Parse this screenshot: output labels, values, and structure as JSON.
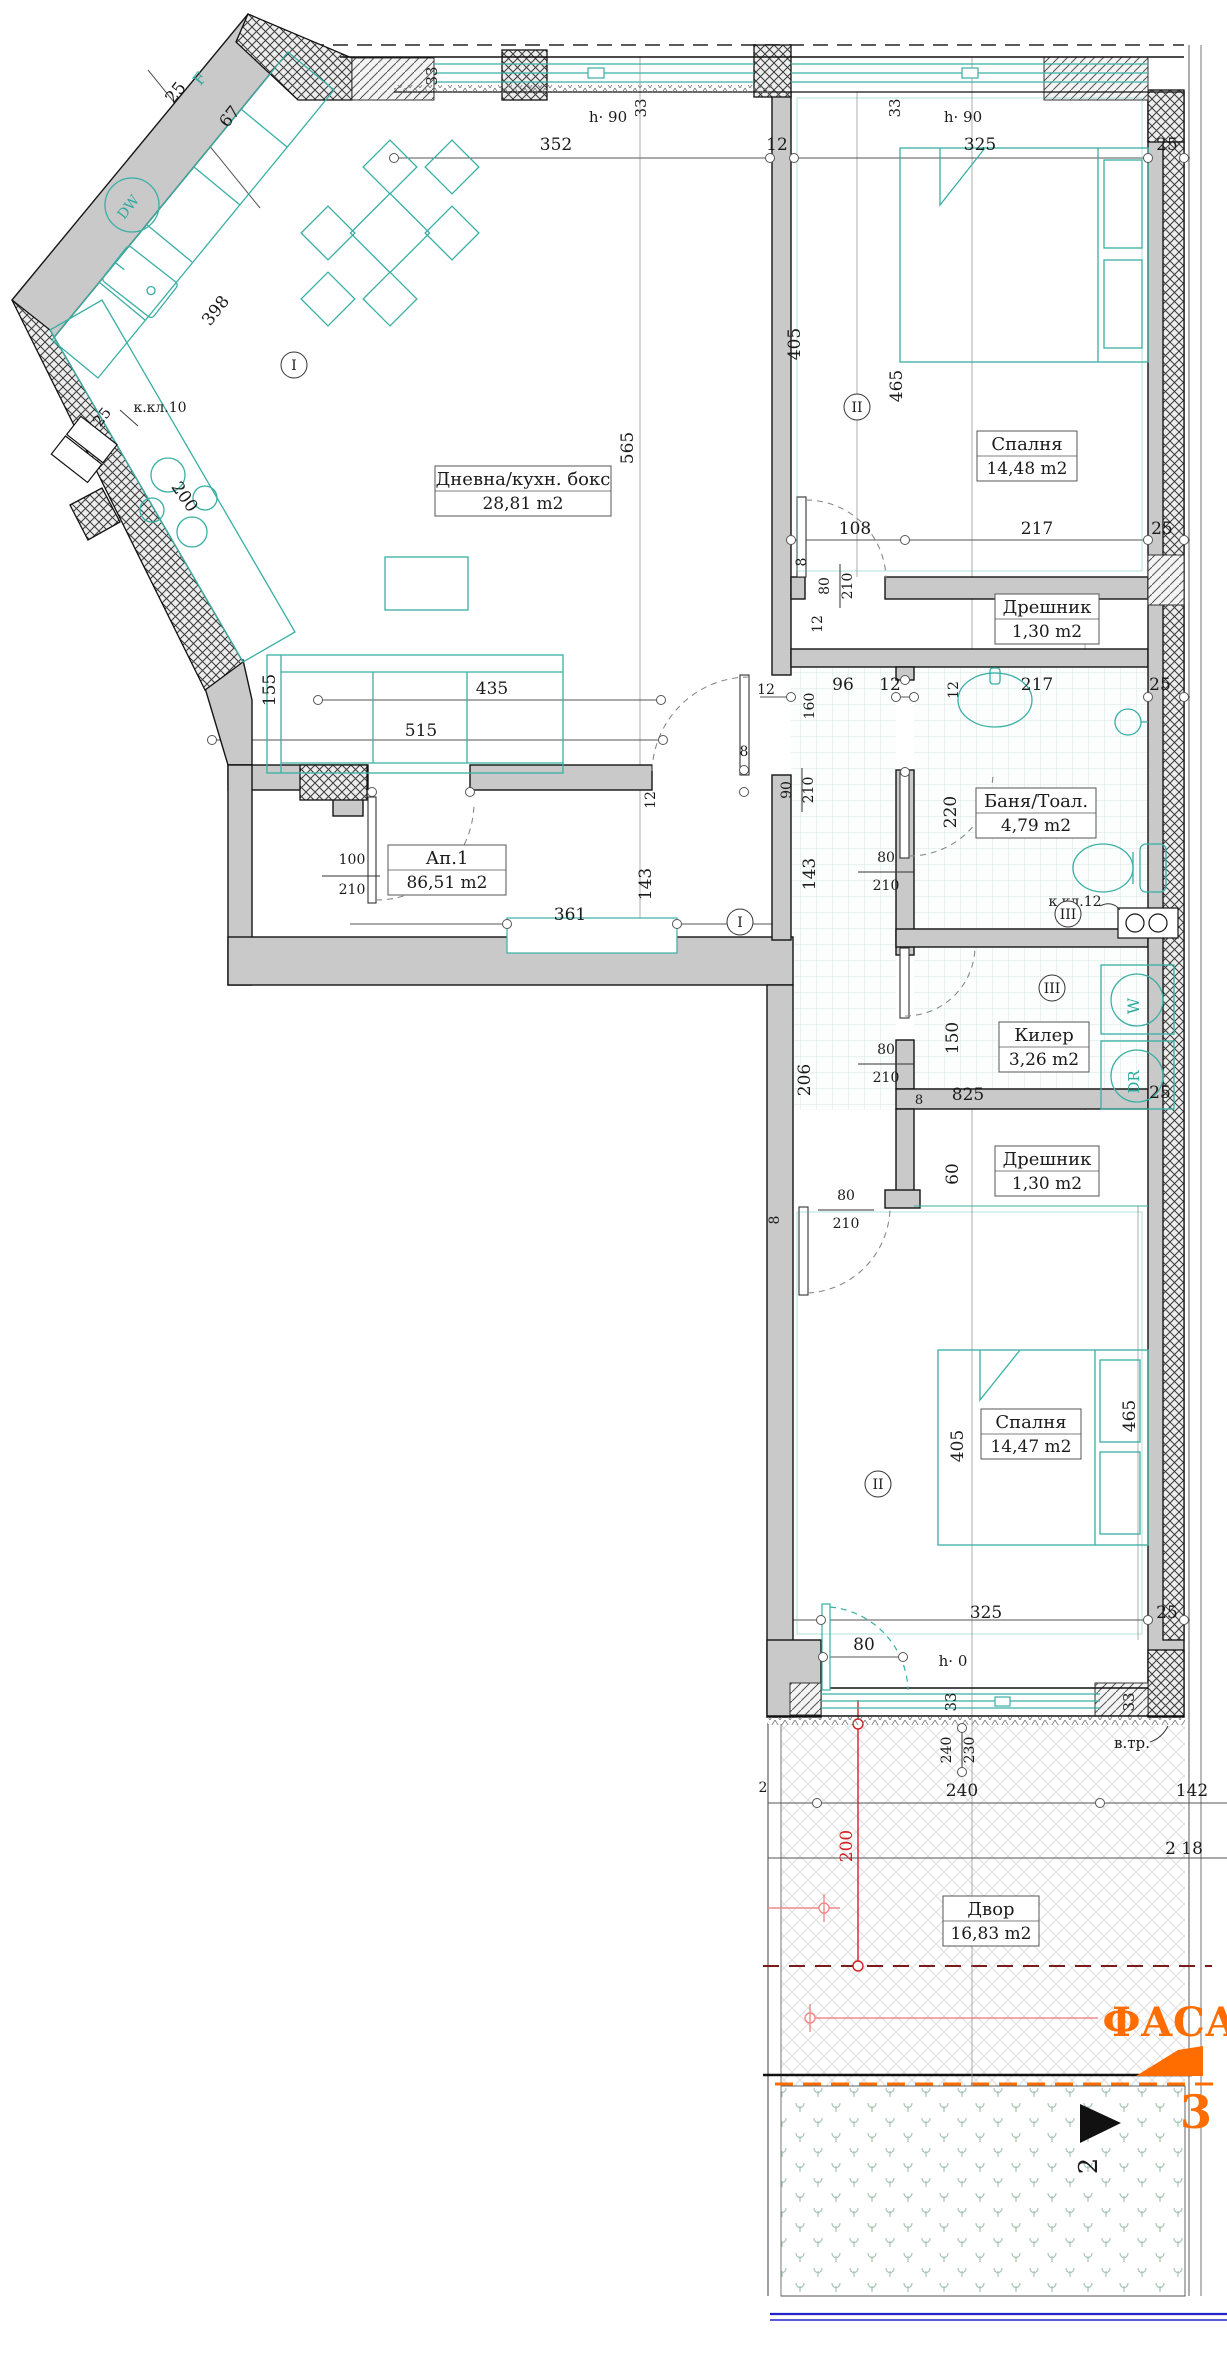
{
  "plan": {
    "title": "Apartment floor plan Ап.1",
    "colors": {
      "wall_gray": "#c9c9c9",
      "furniture_teal": "#38afa4",
      "dim_line": "#555555",
      "red_dim": "#d42020",
      "pink_dim": "#f08a8a",
      "dark_red_dashed": "#7a1b1b",
      "orange_accent": "#ff6d00",
      "blue_line": "#2323cc",
      "grass_green": "#a9c7b6"
    },
    "rooms": [
      {
        "name": "Дневна/кухн. бокс",
        "area": "28,81 m2",
        "cx": 523,
        "top": 466,
        "w": 176
      },
      {
        "name": "Спалня",
        "area": "14,48 m2",
        "cx": 1027,
        "top": 431,
        "w": 100
      },
      {
        "name": "Дрешник",
        "area": "1,30 m2",
        "cx": 1047,
        "top": 594,
        "w": 104
      },
      {
        "name": "Баня/Тоал.",
        "area": "4,79 m2",
        "cx": 1036,
        "top": 788,
        "w": 120
      },
      {
        "name": "Килер",
        "area": "3,26 m2",
        "cx": 1044,
        "top": 1022,
        "w": 90
      },
      {
        "name": "Дрешник",
        "area": "1,30 m2",
        "cx": 1047,
        "top": 1146,
        "w": 104
      },
      {
        "name": "Спалня",
        "area": "14,47 m2",
        "cx": 1031,
        "top": 1409,
        "w": 100
      },
      {
        "name": "Ап.1",
        "area": "86,51 m2",
        "cx": 447,
        "top": 845,
        "w": 118
      },
      {
        "name": "Двор",
        "area": "16,83 m2",
        "cx": 991,
        "top": 1896,
        "w": 96
      }
    ],
    "axis_markers": [
      {
        "t": "I",
        "x": 294,
        "y": 365
      },
      {
        "t": "I",
        "x": 740,
        "y": 922
      },
      {
        "t": "II",
        "x": 857,
        "y": 407
      },
      {
        "t": "II",
        "x": 878,
        "y": 1484
      },
      {
        "t": "III",
        "x": 1068,
        "y": 914
      },
      {
        "t": "III",
        "x": 1052,
        "y": 988
      }
    ],
    "labels": [
      {
        "t": "352",
        "x": 556,
        "y": 150
      },
      {
        "t": "12",
        "x": 777,
        "y": 150
      },
      {
        "t": "325",
        "x": 980,
        "y": 150
      },
      {
        "t": "25",
        "x": 1167,
        "y": 150
      },
      {
        "t": "h· 90",
        "x": 608,
        "y": 122,
        "s": 15
      },
      {
        "t": "h· 90",
        "x": 963,
        "y": 122,
        "s": 15
      },
      {
        "t": "33",
        "x": 437,
        "y": 76,
        "r": -90,
        "s": 15
      },
      {
        "t": "33",
        "x": 646,
        "y": 108,
        "r": -90,
        "s": 15
      },
      {
        "t": "33",
        "x": 900,
        "y": 108,
        "r": -90,
        "s": 15
      },
      {
        "t": "25",
        "x": 180,
        "y": 96,
        "r": -52
      },
      {
        "t": "67",
        "x": 234,
        "y": 120,
        "r": -52
      },
      {
        "t": "398",
        "x": 220,
        "y": 314,
        "r": -52
      },
      {
        "t": "200",
        "x": 180,
        "y": 500,
        "r": 55
      },
      {
        "t": "25",
        "x": 106,
        "y": 420,
        "r": -52,
        "s": 15
      },
      {
        "t": "565",
        "x": 633,
        "y": 448,
        "r": -90
      },
      {
        "t": "155",
        "x": 275,
        "y": 690,
        "r": -90
      },
      {
        "t": "435",
        "x": 492,
        "y": 694
      },
      {
        "t": "515",
        "x": 421,
        "y": 736
      },
      {
        "t": "405",
        "x": 800,
        "y": 344,
        "r": -90
      },
      {
        "t": "465",
        "x": 902,
        "y": 386,
        "r": -90
      },
      {
        "t": "108",
        "x": 855,
        "y": 534
      },
      {
        "t": "217",
        "x": 1037,
        "y": 534
      },
      {
        "t": "25",
        "x": 1162,
        "y": 534
      },
      {
        "t": "8",
        "x": 806,
        "y": 562,
        "r": -90,
        "s": 14
      },
      {
        "t": "80",
        "x": 829,
        "y": 586,
        "r": -90,
        "s": 14
      },
      {
        "t": "210",
        "x": 852,
        "y": 586,
        "r": -90,
        "s": 14
      },
      {
        "t": "12",
        "x": 822,
        "y": 624,
        "r": -90,
        "s": 14
      },
      {
        "t": "12",
        "x": 766,
        "y": 694,
        "s": 14
      },
      {
        "t": "160",
        "x": 814,
        "y": 706,
        "r": -90,
        "s": 14
      },
      {
        "t": "96",
        "x": 843,
        "y": 690
      },
      {
        "t": "12",
        "x": 890,
        "y": 690
      },
      {
        "t": "217",
        "x": 1037,
        "y": 690
      },
      {
        "t": "25",
        "x": 1160,
        "y": 690
      },
      {
        "t": "12",
        "x": 958,
        "y": 690,
        "r": -90,
        "s": 14
      },
      {
        "t": "220",
        "x": 956,
        "y": 812,
        "r": -90
      },
      {
        "t": "143",
        "x": 815,
        "y": 874,
        "r": -90
      },
      {
        "t": "80",
        "x": 886,
        "y": 862,
        "s": 14
      },
      {
        "t": "210",
        "x": 886,
        "y": 890,
        "s": 14
      },
      {
        "t": "к.кл.12",
        "x": 1075,
        "y": 906,
        "c": "note",
        "s": 14
      },
      {
        "t": "143",
        "x": 651,
        "y": 884,
        "r": -90
      },
      {
        "t": "12",
        "x": 655,
        "y": 800,
        "r": -90,
        "s": 14
      },
      {
        "t": "8",
        "x": 744,
        "y": 756,
        "s": 14
      },
      {
        "t": "90",
        "x": 791,
        "y": 790,
        "r": -90,
        "s": 14
      },
      {
        "t": "210",
        "x": 813,
        "y": 790,
        "r": -90,
        "s": 14
      },
      {
        "t": "100",
        "x": 352,
        "y": 864,
        "s": 14
      },
      {
        "t": "210",
        "x": 352,
        "y": 894,
        "s": 14
      },
      {
        "t": "361",
        "x": 570,
        "y": 920
      },
      {
        "t": "206",
        "x": 810,
        "y": 1080,
        "r": -90
      },
      {
        "t": "150",
        "x": 958,
        "y": 1038,
        "r": -90
      },
      {
        "t": "80",
        "x": 886,
        "y": 1054,
        "s": 14
      },
      {
        "t": "210",
        "x": 886,
        "y": 1082,
        "s": 14
      },
      {
        "t": "825",
        "x": 968,
        "y": 1100
      },
      {
        "t": "25",
        "x": 1160,
        "y": 1098
      },
      {
        "t": "8",
        "x": 919,
        "y": 1104,
        "s": 13
      },
      {
        "t": "8",
        "x": 779,
        "y": 1220,
        "r": -90,
        "s": 14
      },
      {
        "t": "80",
        "x": 846,
        "y": 1200,
        "s": 14
      },
      {
        "t": "210",
        "x": 846,
        "y": 1228,
        "s": 14
      },
      {
        "t": "60",
        "x": 958,
        "y": 1174,
        "r": -90
      },
      {
        "t": "405",
        "x": 963,
        "y": 1446,
        "r": -90
      },
      {
        "t": "465",
        "x": 1135,
        "y": 1416,
        "r": -90
      },
      {
        "t": "325",
        "x": 986,
        "y": 1618
      },
      {
        "t": "25",
        "x": 1167,
        "y": 1618
      },
      {
        "t": "80",
        "x": 864,
        "y": 1650
      },
      {
        "t": "h· 0",
        "x": 953,
        "y": 1666,
        "s": 15
      },
      {
        "t": "33",
        "x": 956,
        "y": 1702,
        "r": -90,
        "s": 15
      },
      {
        "t": "33",
        "x": 1134,
        "y": 1702,
        "r": -90,
        "s": 15
      },
      {
        "t": "240",
        "x": 951,
        "y": 1750,
        "r": -90,
        "s": 14
      },
      {
        "t": "230",
        "x": 974,
        "y": 1750,
        "r": -90,
        "s": 14
      },
      {
        "t": "в.тр.",
        "x": 1132,
        "y": 1748,
        "c": "note",
        "s": 15
      },
      {
        "t": "2",
        "x": 763,
        "y": 1792,
        "s": 14
      },
      {
        "t": "240",
        "x": 962,
        "y": 1796
      },
      {
        "t": "142",
        "x": 1192,
        "y": 1796
      },
      {
        "t": "2 18",
        "x": 1184,
        "y": 1854
      },
      {
        "t": "200",
        "x": 852,
        "y": 1846,
        "r": -90,
        "c": "red"
      },
      {
        "t": "ФАСА",
        "x": 1170,
        "y": 2036,
        "c": "orange",
        "s": 40
      },
      {
        "t": "3",
        "x": 1196,
        "y": 2128,
        "c": "orange",
        "s": 46
      },
      {
        "t": "2",
        "x": 1097,
        "y": 2166,
        "r": -90,
        "s": 26
      },
      {
        "t": "к.кл.10",
        "x": 160,
        "y": 412,
        "c": "note",
        "s": 14
      },
      {
        "t": "F",
        "x": 204,
        "y": 82,
        "r": -52,
        "c": "teal",
        "s": 16
      },
      {
        "t": "DW",
        "x": 132,
        "y": 210,
        "r": -52,
        "c": "teal",
        "s": 14
      },
      {
        "t": "W",
        "x": 1139,
        "y": 1006,
        "r": -90,
        "c": "teal",
        "s": 16
      },
      {
        "t": "DR",
        "x": 1139,
        "y": 1082,
        "r": -90,
        "c": "teal",
        "s": 15
      }
    ],
    "fraction_bars": [
      {
        "x1": 322,
        "y1": 876,
        "x2": 380,
        "y2": 876
      },
      {
        "x1": 840,
        "y1": 564,
        "x2": 840,
        "y2": 608
      },
      {
        "x1": 802,
        "y1": 768,
        "x2": 802,
        "y2": 812
      },
      {
        "x1": 858,
        "y1": 872,
        "x2": 914,
        "y2": 872
      },
      {
        "x1": 858,
        "y1": 1064,
        "x2": 914,
        "y2": 1064
      },
      {
        "x1": 818,
        "y1": 1210,
        "x2": 874,
        "y2": 1210
      },
      {
        "x1": 962,
        "y1": 1728,
        "x2": 962,
        "y2": 1772
      }
    ],
    "ticks": [
      {
        "x": 394,
        "y": 158
      },
      {
        "x": 770,
        "y": 158
      },
      {
        "x": 794,
        "y": 158
      },
      {
        "x": 1148,
        "y": 158
      },
      {
        "x": 1184,
        "y": 158
      },
      {
        "x": 791,
        "y": 540
      },
      {
        "x": 905,
        "y": 540
      },
      {
        "x": 1148,
        "y": 540
      },
      {
        "x": 1184,
        "y": 540
      },
      {
        "x": 791,
        "y": 697
      },
      {
        "x": 896,
        "y": 697
      },
      {
        "x": 914,
        "y": 697
      },
      {
        "x": 1148,
        "y": 697
      },
      {
        "x": 1184,
        "y": 697
      },
      {
        "x": 507,
        "y": 924
      },
      {
        "x": 677,
        "y": 924
      },
      {
        "x": 318,
        "y": 700
      },
      {
        "x": 661,
        "y": 700
      },
      {
        "x": 212,
        "y": 740
      },
      {
        "x": 663,
        "y": 740
      },
      {
        "x": 821,
        "y": 1620
      },
      {
        "x": 1148,
        "y": 1620
      },
      {
        "x": 1184,
        "y": 1620
      },
      {
        "x": 823,
        "y": 1657
      },
      {
        "x": 903,
        "y": 1657
      },
      {
        "x": 817,
        "y": 1803
      },
      {
        "x": 1100,
        "y": 1803
      },
      {
        "x": 744,
        "y": 770
      },
      {
        "x": 744,
        "y": 792
      },
      {
        "x": 372,
        "y": 792
      },
      {
        "x": 470,
        "y": 792
      },
      {
        "x": 962,
        "y": 1728
      },
      {
        "x": 962,
        "y": 1772
      },
      {
        "x": 905,
        "y": 680
      },
      {
        "x": 905,
        "y": 772
      }
    ]
  }
}
